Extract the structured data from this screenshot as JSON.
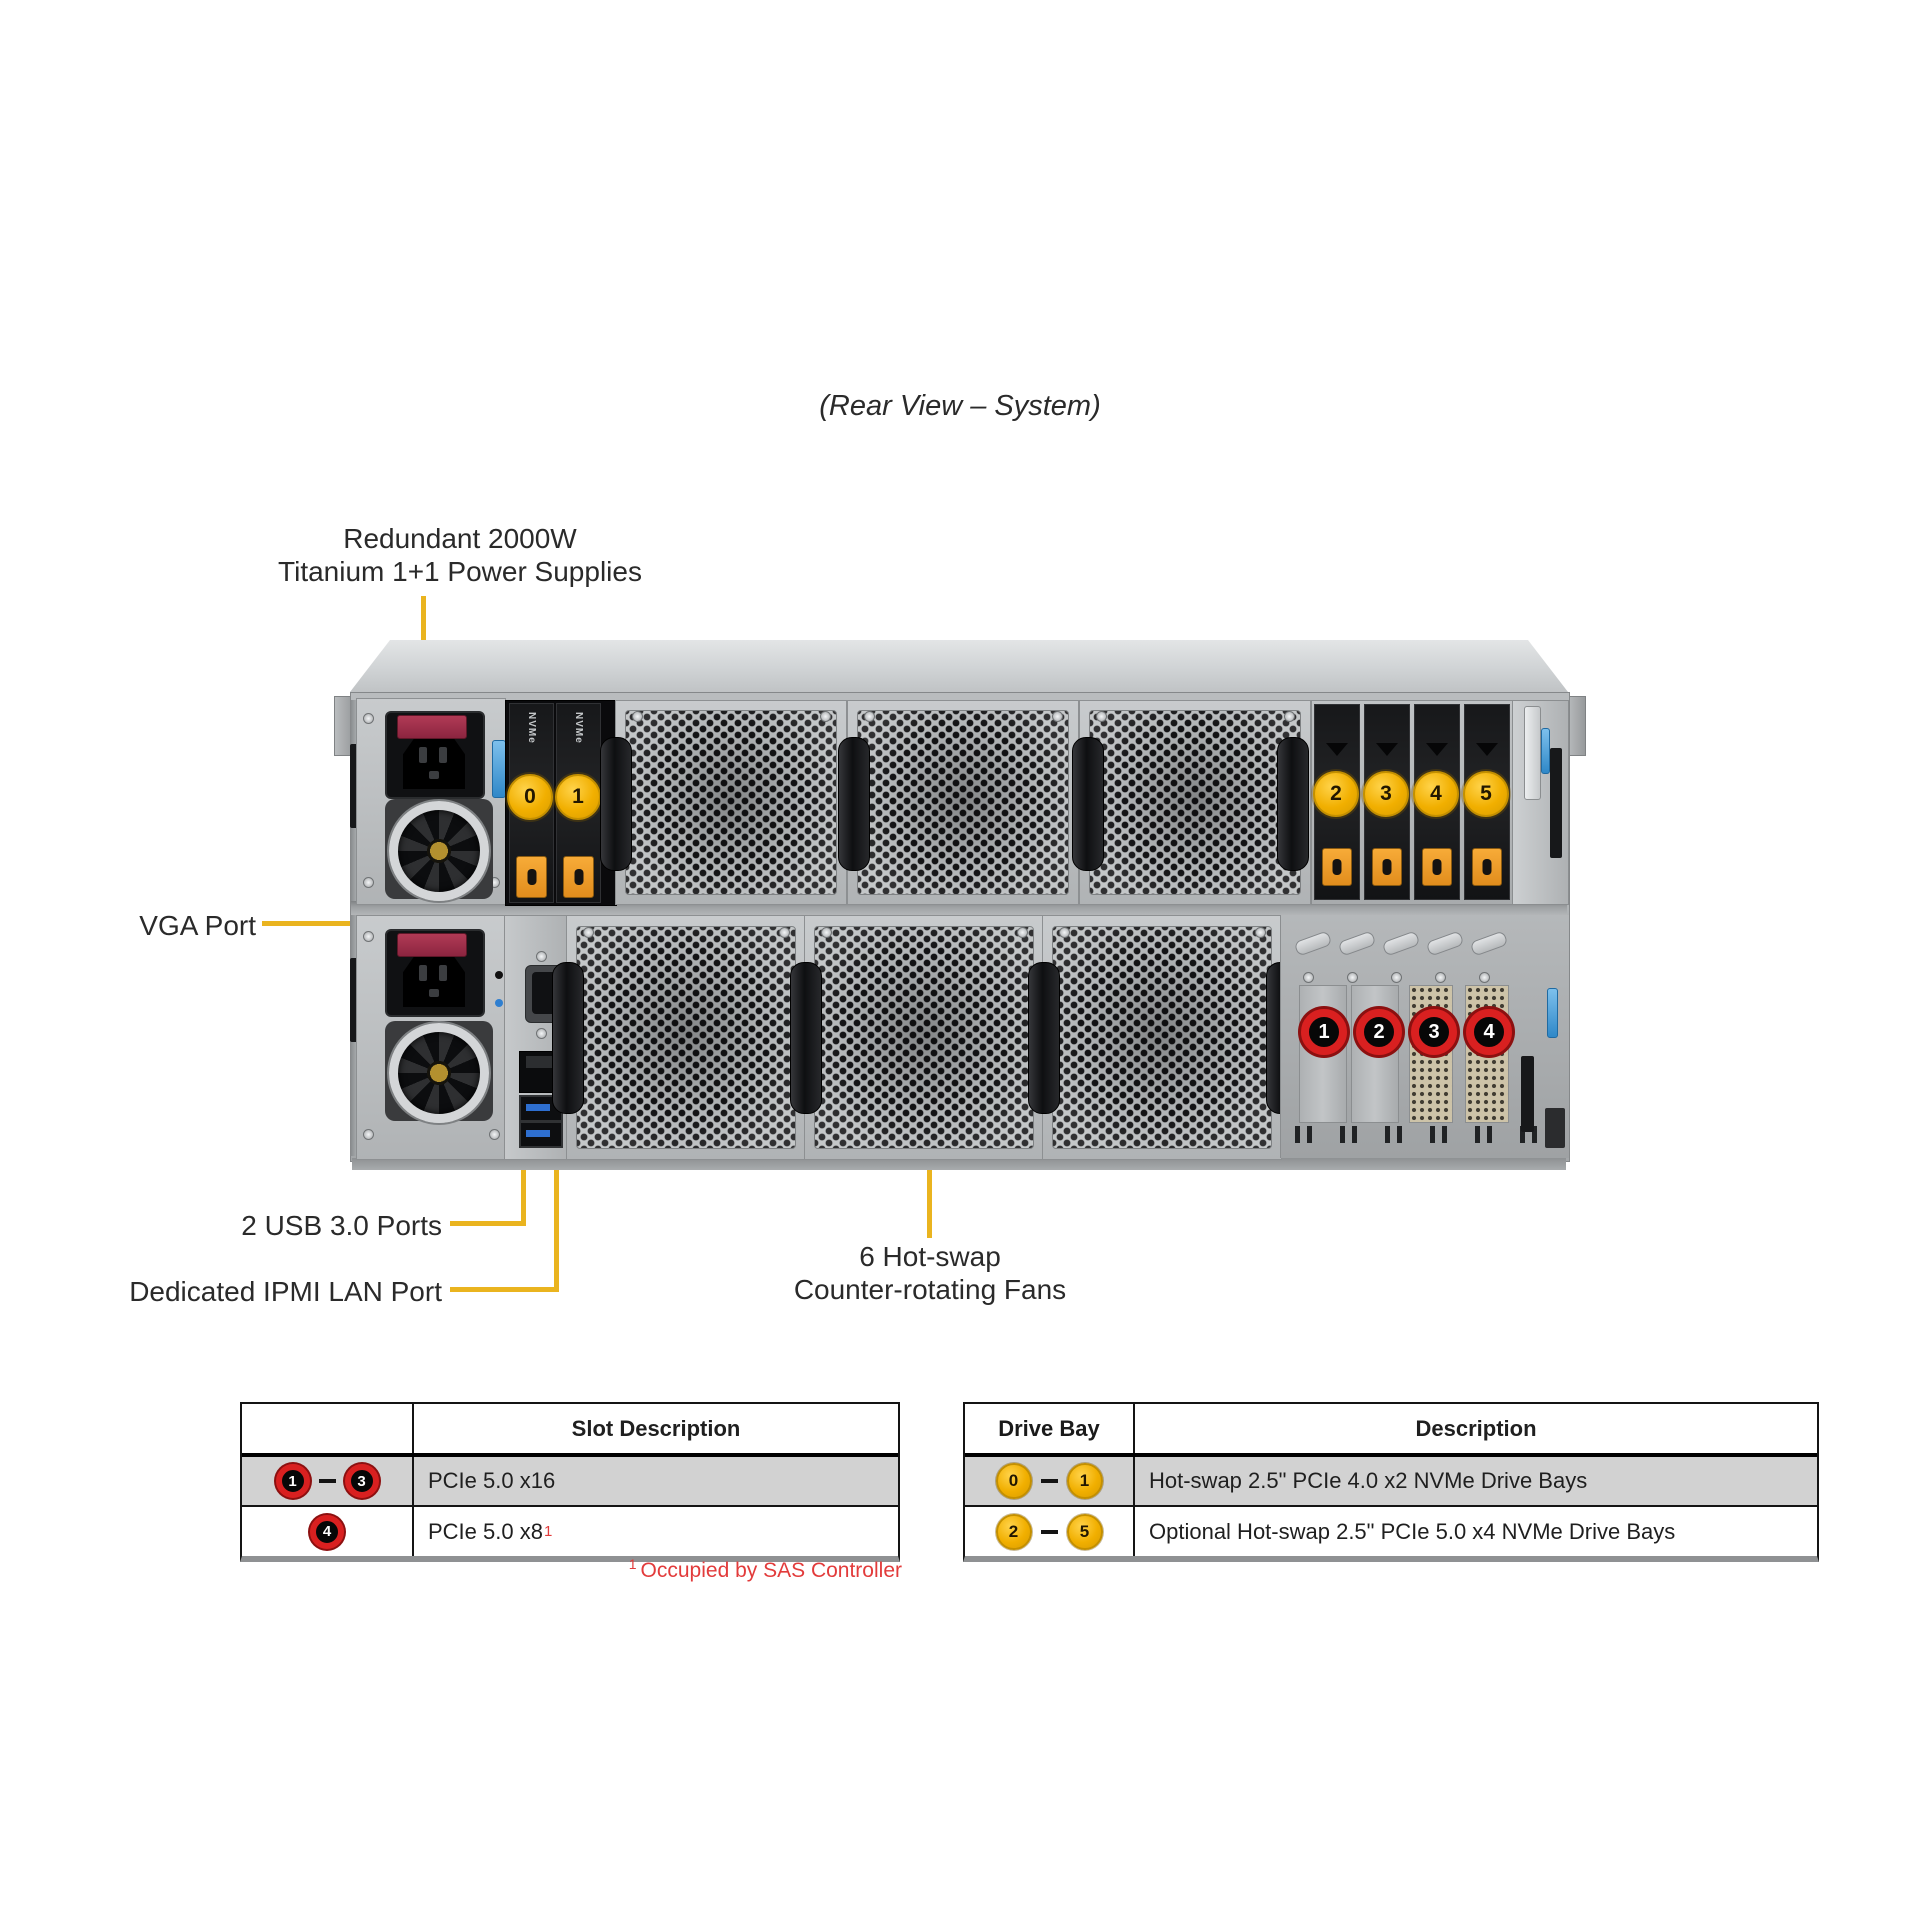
{
  "title": "(Rear View – System)",
  "callouts": {
    "psu_line1": "Redundant 2000W",
    "psu_line2": "Titanium 1+1 Power Supplies",
    "vga": "VGA Port",
    "usb": "2 USB 3.0 Ports",
    "ipmi": "Dedicated IPMI LAN Port",
    "fans_line1": "6 Hot-swap",
    "fans_line2": "Counter-rotating Fans"
  },
  "chassis": {
    "nvme_label": "NVMe",
    "front_bay_badges": [
      "0",
      "1"
    ],
    "rear_bay_badges": [
      "2",
      "3",
      "4",
      "5"
    ],
    "pcie_badges": [
      "1",
      "2",
      "3",
      "4"
    ]
  },
  "slot_table": {
    "header": "Slot Description",
    "row1": {
      "from": "1",
      "to": "3",
      "desc": "PCIe 5.0 x16"
    },
    "row2": {
      "slot": "4",
      "desc": "PCIe 5.0 x8",
      "mark": "1"
    },
    "footnote_mark": "1",
    "footnote": "Occupied by SAS Controller"
  },
  "drive_table": {
    "header_col1": "Drive Bay",
    "header_col2": "Description",
    "row1": {
      "from": "0",
      "to": "1",
      "desc": "Hot-swap 2.5\" PCIe 4.0 x2 NVMe Drive Bays"
    },
    "row2": {
      "from": "2",
      "to": "5",
      "desc": "Optional Hot-swap 2.5\" PCIe 5.0 x4 NVMe Drive Bays"
    }
  },
  "colors": {
    "callout_yellow": "#EAB41F",
    "badge_yellow": "#F2B200",
    "badge_red": "#D92020",
    "table_row_gray": "#D2D2D2",
    "footnote_red": "#E23B3B"
  }
}
